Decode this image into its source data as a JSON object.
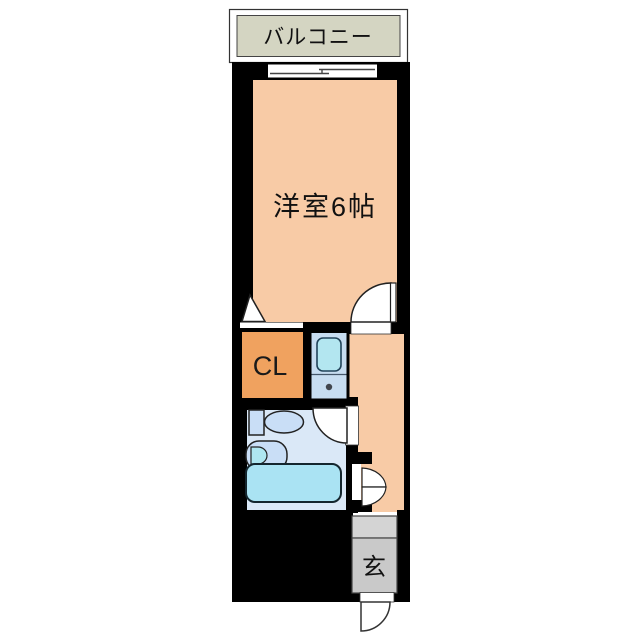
{
  "floorplan": {
    "title": "1K apartment floor plan",
    "balcony": {
      "label": "バルコニー"
    },
    "room": {
      "label": "洋室6帖"
    },
    "closet": {
      "label": "CL"
    },
    "entrance": {
      "label": "玄"
    },
    "colors": {
      "wall": "#000000",
      "room": "#F8CBA6",
      "balcony": "#D4D5C2",
      "closet": "#F0A25F",
      "kitchen": "#C7DDF1",
      "kitchen_sink": "#B3E6F0",
      "bathroom": "#DAE8F7",
      "fixture": "#C9DEF6",
      "basin_bowl": "#AEE6F0",
      "bathtub": "#AAE3F3",
      "entrance_floor": "#C9C9C9",
      "entrance_step": "#D4D4D4",
      "door": "#FFFFFF"
    }
  }
}
